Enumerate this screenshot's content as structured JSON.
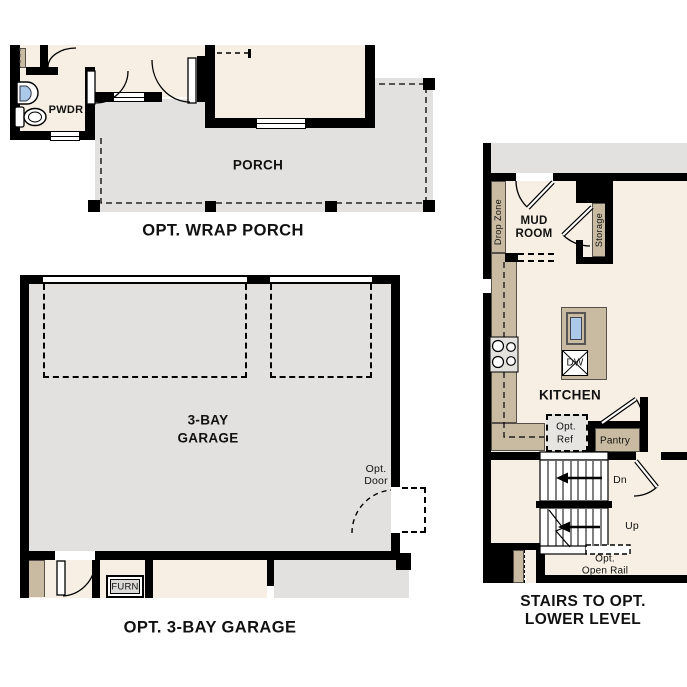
{
  "colors": {
    "cream": "#f7efe4",
    "gray": "#e3e1df",
    "tan": "#c9bba2",
    "blue": "#abc9e8",
    "wall": "#000000",
    "ref_gray": "#e7e5e1",
    "furn_gray": "#dcdad7",
    "text": "#111111"
  },
  "wrap_porch": {
    "caption": "OPT. WRAP PORCH",
    "powder_label": "PWDR",
    "porch_label": "PORCH"
  },
  "garage": {
    "caption": "OPT. 3-BAY GARAGE",
    "name_line1": "3-BAY",
    "name_line2": "GARAGE",
    "opt_door_line1": "Opt.",
    "opt_door_line2": "Door",
    "furnace_label": "FURN"
  },
  "stairs": {
    "caption_line1": "STAIRS TO OPT.",
    "caption_line2": "LOWER LEVEL",
    "drop_zone_label": "Drop Zone",
    "mud_room_line1": "MUD",
    "mud_room_line2": "ROOM",
    "storage_label": "Storage",
    "kitchen_label": "KITCHEN",
    "dishwasher_label": "DW",
    "opt_ref_line1": "Opt.",
    "opt_ref_line2": "Ref",
    "pantry_label": "Pantry",
    "down_label": "Dn",
    "up_label": "Up",
    "open_rail_line1": "Opt.",
    "open_rail_line2": "Open Rail"
  }
}
